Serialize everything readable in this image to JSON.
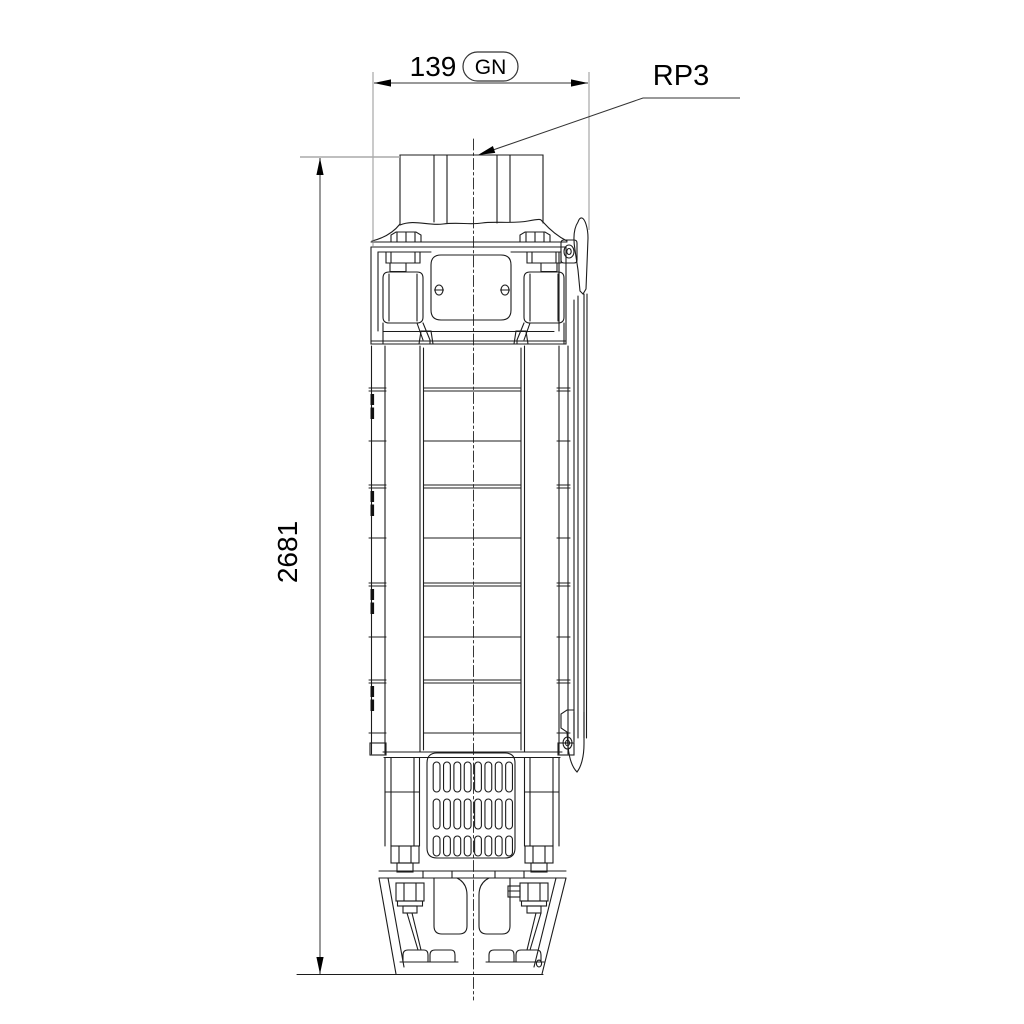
{
  "page": {
    "background": "#ffffff"
  },
  "drawing": {
    "line_color": "#1c1c1c",
    "dimension_line_color": "#333333",
    "extension_line_color": "#8a8a8a",
    "annotation_color": "#000000",
    "labels": {
      "width_value": "139",
      "width_badge": "GN",
      "connection": "RP3",
      "height_value": "2681"
    }
  }
}
